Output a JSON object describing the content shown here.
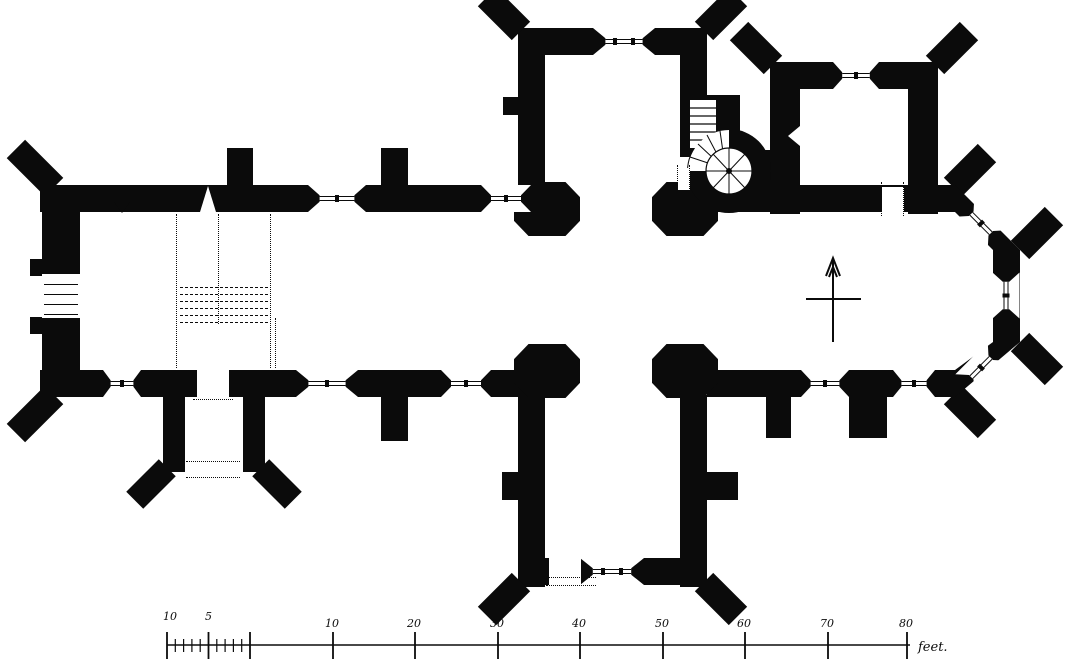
{
  "canvas": {
    "width_px": 1068,
    "height_px": 672,
    "ink_color": "#0b0b0b",
    "paper_color": "#ffffff"
  },
  "drawing": {
    "kind": "measured ground plan of a cruciform church, black-ink blocked walls"
  },
  "compass": {
    "icon": "north-arrow",
    "direction": "up"
  },
  "scale_bar": {
    "unit_label": "feet.",
    "baseline_y": 645,
    "line_end_x": 910,
    "subdivided": {
      "x_start": 167,
      "x_end": 250,
      "minor_ticks": 10,
      "labels": [
        {
          "text": "10",
          "x": 163
        },
        {
          "text": "5",
          "x": 205
        }
      ]
    },
    "main_ticks": [
      {
        "text": "10",
        "x": 333
      },
      {
        "text": "20",
        "x": 415
      },
      {
        "text": "30",
        "x": 498
      },
      {
        "text": "40",
        "x": 580
      },
      {
        "text": "50",
        "x": 663
      },
      {
        "text": "60",
        "x": 745
      },
      {
        "text": "70",
        "x": 828
      },
      {
        "text": "80",
        "x": 907
      }
    ]
  }
}
